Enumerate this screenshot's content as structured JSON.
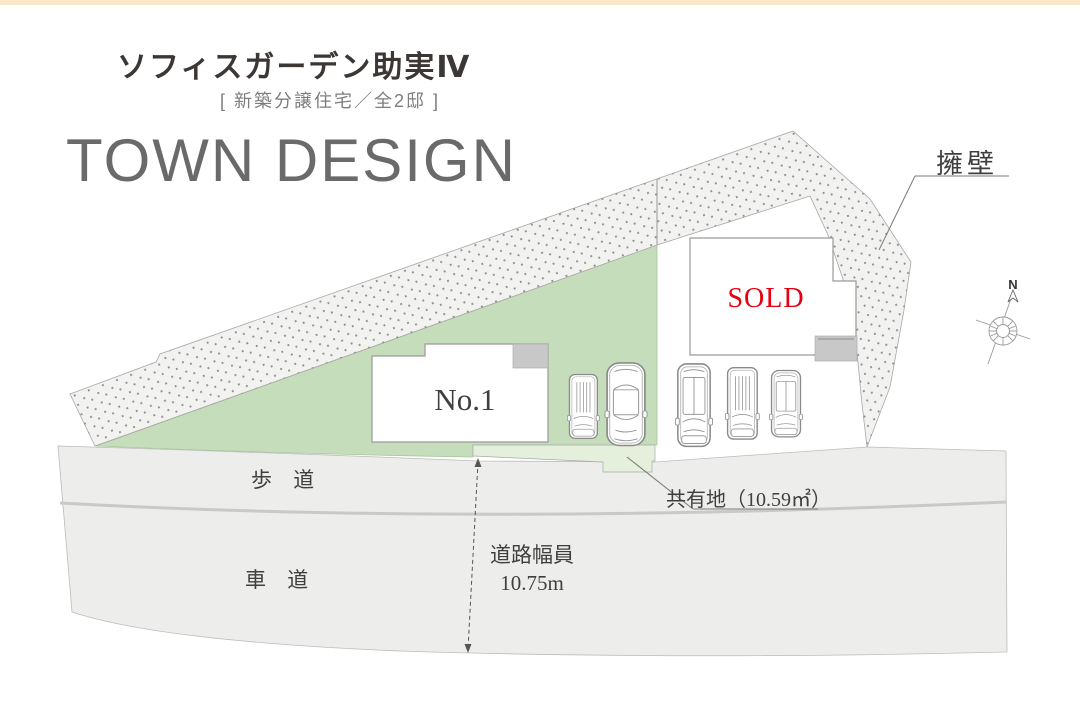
{
  "header": {
    "title": "ソフィスガーデン助実Ⅳ",
    "subtitle": "[ 新築分譲住宅／全2邸 ]",
    "heading": "TOWN DESIGN"
  },
  "plan": {
    "wall_label": "擁壁",
    "building_no1_label": "No.1",
    "building_sold_label": "SOLD",
    "sidewalk_label": "歩 道",
    "roadway_label": "車 道",
    "road_width_line1": "道路幅員",
    "road_width_line2": "10.75m",
    "shared_area_label": "共有地（10.59㎡）",
    "compass_north_label": "N"
  },
  "colors": {
    "accent_bar": "#fbe8ca",
    "site_green": "#c6ddbc",
    "shared_green": "#e4efdc",
    "road_gray": "#ededec",
    "wall_fill": "#f2f2f1",
    "wall_dots": "#8d8d8d",
    "porch_gray": "#c8c8c8",
    "sold_red": "#e60012",
    "heading_gray": "#6a6a6a",
    "title_dark": "#3c3734"
  }
}
